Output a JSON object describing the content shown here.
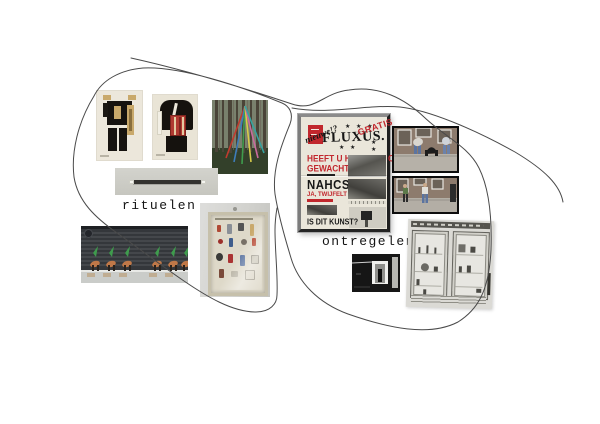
{
  "page": {
    "background": "#ffffff"
  },
  "clusters": {
    "left": {
      "label": "rituelen"
    },
    "right": {
      "label": "ontregelen"
    }
  },
  "poster": {
    "script_word": "nieuwe!?",
    "title": "FLUXUS.",
    "stamp": "GRATIS",
    "stars_top": "★ ★ ★",
    "stars_right": "★ ★",
    "stars_mid": "★ ★",
    "headline_line1": "HEEFT U HIER NIET OP",
    "headline_line2": "GEWACHT ?",
    "word_reversed": "NAHCSO",
    "red_line": "JA, TWIJFELT ?",
    "bottom_question": "IS DIT KUNST?"
  },
  "colors": {
    "poster_red": "#c1272d",
    "poster_paper": "#eae6da",
    "label_ink": "#141414",
    "scribble_line": "#4a4a4a"
  }
}
